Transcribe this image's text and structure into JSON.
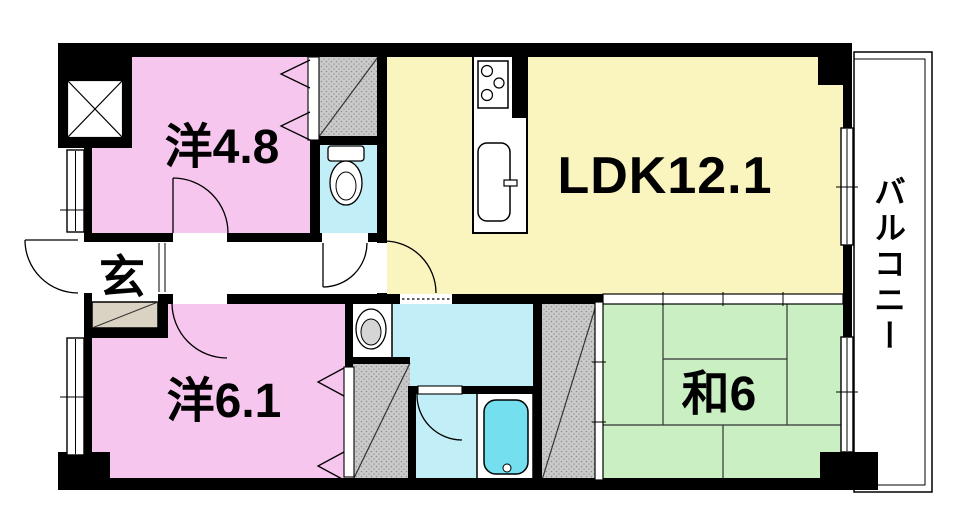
{
  "plan": {
    "rooms": {
      "western48": {
        "label": "洋4.8"
      },
      "ldk": {
        "label": "LDK12.1"
      },
      "western61": {
        "label": "洋6.1"
      },
      "japanese6": {
        "label": "和6"
      },
      "entrance": {
        "label": "玄"
      },
      "balcony": {
        "label": "バルコニー"
      }
    },
    "colors": {
      "western_room": "#F7C6EE",
      "ldk_room": "#FAF4BE",
      "japanese_room": "#C9EFC2",
      "wet_area": "#C2EFF7",
      "bathtub_water": "#74DFEF",
      "closet_fill": "#CBCBCB",
      "shoe_cabinet": "#DAD2C2",
      "wall": "#000000"
    }
  }
}
